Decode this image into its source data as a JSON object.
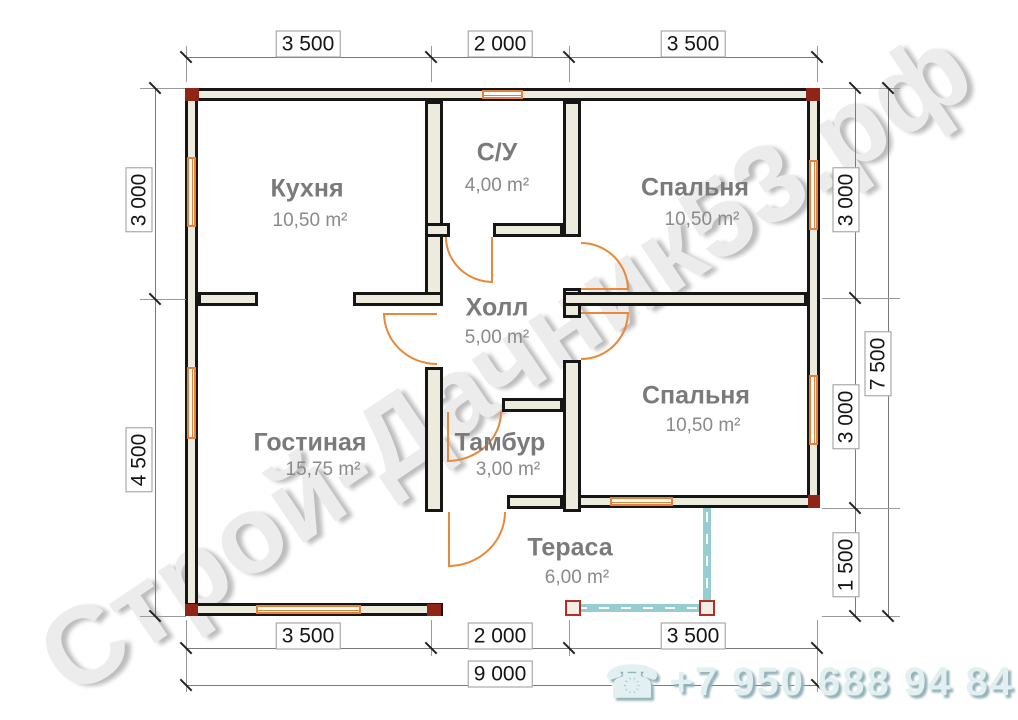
{
  "watermark": {
    "text": "Строй-Дачник53.рф"
  },
  "footer": {
    "phone": "+7 950 688 94 84",
    "phone_icon": "☎"
  },
  "colors": {
    "wall_fill": "#edebdd",
    "wall_line": "#161616",
    "window": "#e6813c",
    "door": "#e8883a",
    "terrace_edge": "#96cdd1",
    "corner_marker": "#8f2517",
    "dimension_line": "#7a7a7a",
    "room_label": "#7a7a7a"
  },
  "rooms": [
    {
      "name": "Кухня",
      "area": "10,50 m²"
    },
    {
      "name": "С/У",
      "area": "4,00 m²"
    },
    {
      "name": "Спальня",
      "area": "10,50 m²"
    },
    {
      "name": "Холл",
      "area": "5,00 m²"
    },
    {
      "name": "Гостиная",
      "area": "15,75 m²"
    },
    {
      "name": "Тамбур",
      "area": "3,00 m²"
    },
    {
      "name": "Спальня",
      "area": "10,50 m²"
    },
    {
      "name": "Тераса",
      "area": "6,00 m²"
    }
  ],
  "dimensions": {
    "top": [
      "3 500",
      "2 000",
      "3 500"
    ],
    "bottom": [
      "3 500",
      "2 000",
      "3 500"
    ],
    "bottom_total": "9 000",
    "left": [
      "3 000",
      "4 500"
    ],
    "right": [
      "3 000",
      "3 000",
      "1 500"
    ],
    "right_total": "7 500"
  }
}
